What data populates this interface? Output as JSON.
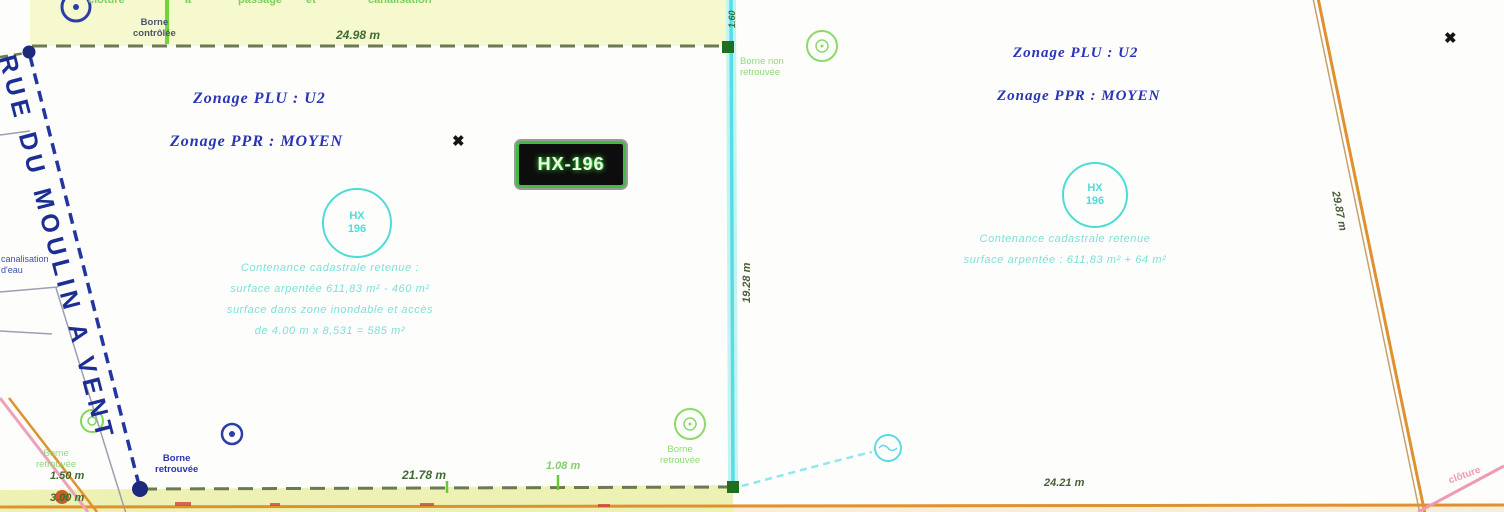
{
  "zones": {
    "left_plu": "Zonage PLU : U2",
    "left_ppr": "Zonage PPR : MOYEN",
    "right_plu": "Zonage PLU : U2",
    "right_ppr": "Zonage PPR : MOYEN"
  },
  "parcel_box_label": "HX-196",
  "parcel_circles": {
    "left": {
      "line1": "HX",
      "line2": "196"
    },
    "right": {
      "line1": "HX",
      "line2": "196"
    }
  },
  "notes": {
    "left": [
      "Contenance cadastrale retenue :",
      "surface arpentée 611,83 m² - 460 m²",
      "surface dans zone inondable et accès",
      "de 4.00 m x 8,531 = 585 m²"
    ],
    "right": [
      "Contenance cadastrale retenue",
      "surface arpentée : 611,83 m² + 64 m²"
    ]
  },
  "markers": {
    "borne_top_left": "Borne\ncontrôlée",
    "borne_bottom_left_green": "Borne\nretrouvée",
    "borne_bottom_left_blue": "Borne\nretrouvée",
    "borne_bottom_center_green": "Borne\nretrouvée",
    "borne_top_center_green": "Borne non\nretrouvée"
  },
  "measurements": {
    "top_edge": "24.98 m",
    "bottom_left_a": "1.50 m",
    "bottom_left_b": "3.00 m",
    "bottom_center": "21.78 m",
    "bottom_small": "1.08 m",
    "center_vertical": "19.28 m",
    "right_diagonal": "29.87 m",
    "bottom_right": "24.21 m",
    "top_center_vertical": "1.60"
  },
  "street_name": "RUE DU MOULIN A VENT",
  "edge_labels": {
    "top_fragments": [
      "clôture",
      "a",
      "passage",
      "et",
      "canalisation"
    ],
    "left_canalisation": "canalisation\nd'eau",
    "bottom_right_pink": "clôture"
  },
  "icons": {
    "x_marker": "✖"
  },
  "colors": {
    "zone_text": "#2a35b5",
    "cyan_line": "#55dde8",
    "teal_text": "#4fdcd6",
    "dark_green": "#3f6b33",
    "light_green": "#8fd978",
    "bright_green": "#6ed63a",
    "boundary_dash": "#6b7a52",
    "orange_road": "#e0912f",
    "pink": "#ef9ab5",
    "navy_road": "#1c2d93",
    "yellow_band": "#f6f8cd",
    "bottom_strip": "#edf2b4"
  }
}
